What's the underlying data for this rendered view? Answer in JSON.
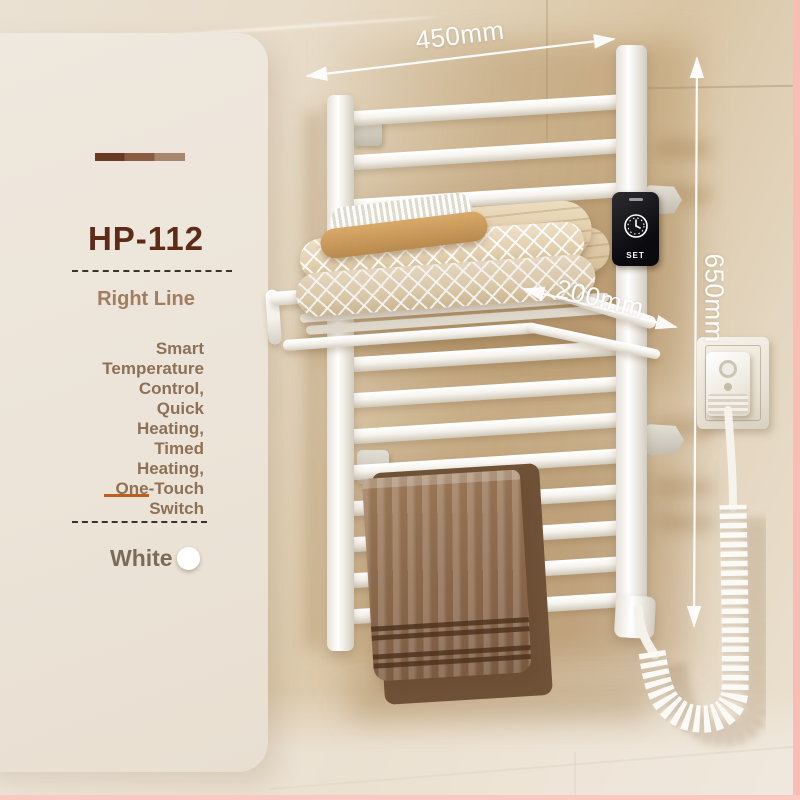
{
  "product": {
    "model": "HP-112",
    "line": "Right Line",
    "features": "Smart\nTemperature\nControl,\nQuick\nHeating,\nTimed\nHeating,\nOne-Touch\nSwitch",
    "color_label": "White",
    "color_swatch_hex": "#ffffff"
  },
  "dimensions": {
    "width": "450mm",
    "height": "650mm",
    "depth": "200mm"
  },
  "control_panel": {
    "set_label": "SET"
  },
  "palette": {
    "model_text": "#5e2b19",
    "line_text": "#a07e5f",
    "features_text": "#8d7156",
    "accent_underline": "#bf5f1e",
    "gradient_bar": [
      "#6b3a22",
      "#8a5c41",
      "#a8876f"
    ],
    "edge_strip_pink": "#f8beb6",
    "wall_beige": "#decdb0",
    "rack_white": "#ffffff",
    "towel_brown": "#937154"
  }
}
